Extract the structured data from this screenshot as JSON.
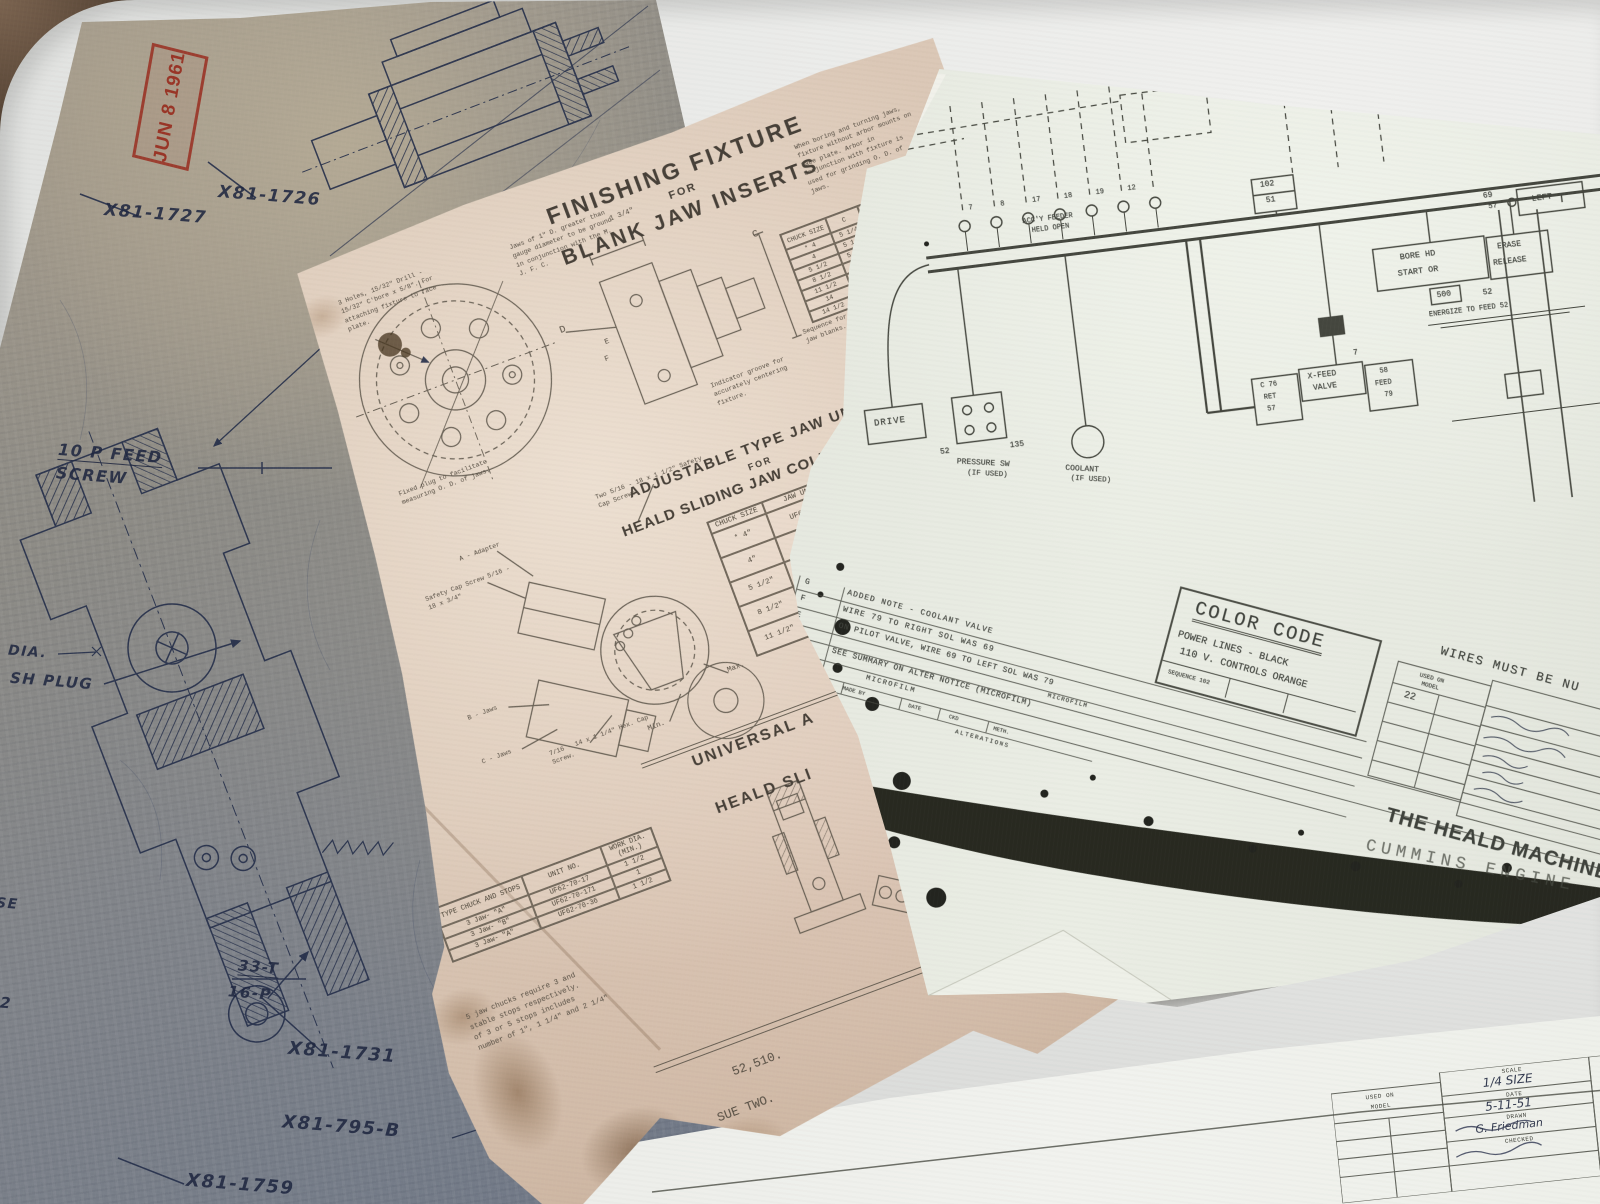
{
  "stamp": {
    "date": "JUN 8 1961"
  },
  "blueprint": {
    "part_1726": "X81-1726",
    "part_1727": "X81-1727",
    "feed_line1": "10 P FEED",
    "feed_line2": "SCREW",
    "dia": "DIA.",
    "sh_plug": "SH PLUG",
    "gear_teeth": "33-T",
    "gear_pitch": "16-P",
    "part_1731": "X81-1731",
    "part_795b": "X81-795-B",
    "part_1759": "X81-1759",
    "edge_se": "SE",
    "edge_2": "2"
  },
  "fixture": {
    "title1": "FINISHING FIXTURE",
    "for1": "FOR",
    "title2": "BLANK JAW INSERTS",
    "note_boring": "When boring and turning jaws, fixture without arbor mounts on face plate. Arbor in conjunction with fixture is used for grinding O. D. of jaws.",
    "note_holes": "3 Holes, 15/32\" Drill - 15/32\" C'bore x 5/8\". For attaching fixture to face plate.",
    "note_jaws": "Jaws of 1\" D. greater than gauge diameter to be ground in conjunction with the M. J. F. C.",
    "note_plug": "Fixed plug to facilitate measuring O. D. of jaws.",
    "note_indicator": "Indicator groove for accurately centering fixture.",
    "note_sequence": "Sequence for grinding jaw blanks.",
    "dim_134": "1 3/4\"",
    "dim_c": "C",
    "dim_d": "D",
    "dim_e": "E",
    "dim_f": "F",
    "dim_table": {
      "h_chuck": "CHUCK SIZE",
      "h_c": "C",
      "h_d": "D",
      "h_d_tol": "+.0005 -.0000",
      "h_e": "E",
      "rows": [
        [
          "* 4",
          "5 1/4",
          "5.3120"
        ],
        [
          "4",
          "5 1/2",
          "5.5620"
        ],
        [
          "5 1/2",
          "5 5/8",
          "5.3745"
        ],
        [
          "8 1/2",
          "9 7/8",
          "9.40"
        ],
        [
          "11 1/2",
          "- - -",
          "- - -"
        ],
        [
          "14",
          "- - -",
          "- - -"
        ],
        [
          "14 1/2",
          "- - -",
          "- - -"
        ]
      ]
    },
    "adj_title1": "ADJUSTABLE TYPE JAW UNITS",
    "for2": "FOR",
    "adj_title2": "HEALD SLIDING JAW COLLET CHUCK",
    "unit_table": {
      "h1a": "CHUCK",
      "h1b": "SIZE",
      "h2a": "JAW UNIT",
      "h2b": "SET",
      "rows": [
        [
          "* 4\"",
          "UF62-70-160A"
        ],
        [
          "4\"",
          "UF62-70-94"
        ],
        [
          "5 1/2\"",
          "UF62-70-"
        ],
        [
          "8 1/2\"",
          "UF62-"
        ],
        [
          "11 1/2\"",
          ""
        ]
      ]
    },
    "lbl_adapter": "A - Adapter",
    "lbl_cap1": "Safety Cap Screw 5/16 - 18 x 3/4\"",
    "lbl_cap2": "Two 5/16 - 18 x 1 1/2\" Safety Cap Screws.",
    "lbl_bjaws": "B - Jaws",
    "lbl_cjaws": "C - Jaws",
    "lbl_hex": "7/16 - 14 x 1 1/4\" Hex. Cap Screw.",
    "lbl_max": "Max.",
    "lbl_min": "Min.",
    "note_each": "Each wher",
    "uni_title1": "UNIVERSAL A",
    "uni_title2": "HEALD SLI",
    "stop_table": {
      "h1": "TYPE CHUCK AND STOPS",
      "h2": "UNIT NO.",
      "h3": "WORK DIA. (MIN.)",
      "rows": [
        [
          "3 Jaw- \"A\"",
          "UF62-70-17",
          "1 1/2"
        ],
        [
          "3 Jaw- \"B\"",
          "UF62-70-171",
          "1"
        ],
        [
          "3 Jaw- \"A\"",
          "UF62-70-36",
          "1 1/2"
        ]
      ]
    },
    "para": [
      "5 jaw chucks require 3 and",
      "stable stops respectively.",
      "of 3 or 5 stops includes",
      "number of 1\", 1 1/4\" and 2 1/4\""
    ],
    "lbl_nut1": "Square nut (hard)",
    "lbl_nut2": "3/8\" - 16 tap x 3/8\".",
    "lbl_forno": "* For No.",
    "doc_number": "52,510.",
    "issue": "SUE TWO."
  },
  "schematic": {
    "contacts": [
      "7",
      "8",
      "17",
      "18",
      "19",
      "12"
    ],
    "accy1": "ACC'Y FEEDER",
    "accy2": "HELD OPEN",
    "box102": "102",
    "box51": "51",
    "num69": "69",
    "num57": "57",
    "lbl_left": "LEFT",
    "borehd1": "BORE HD",
    "borehd2": "START OR",
    "erase": "ERASE",
    "release": "RELEASE",
    "num500": "500",
    "num52r": "52",
    "energize": "ENERGIZE TO FEED 52",
    "xfeed_l1": "C 76",
    "xfeed_l2": "RET",
    "xfeed_l3": "57",
    "xfeed_m1": "X-FEED",
    "xfeed_m2": "VALVE",
    "xfeed_r1": "58",
    "xfeed_r2": "FEED",
    "xfeed_r3": "79",
    "num7": "7",
    "drive": "DRIVE",
    "num52": "52",
    "num135": "135",
    "pressure1": "PRESSURE SW",
    "pressure2": "(IF USED)",
    "coolant1": "COOLANT",
    "coolant2": "(IF USED)",
    "color_code": {
      "title": "COLOR CODE",
      "line1": "POWER LINES - BLACK",
      "line2": "110 V. CONTROLS ORANGE",
      "seq": "SEQUENCE 102"
    },
    "alt": {
      "r1l": "G",
      "r1t": "ADDED NOTE - COOLANT VALVE",
      "r2l": "F",
      "r2t": "WIRE 79 TO RIGHT SOL WAS 69",
      "r3l": "E",
      "r3t": "ON PILOT VALVE, WIRE 69 TO LEFT SOL WAS 79",
      "r4t": "MICROFILM",
      "r5l": "LET.",
      "r5t": "SEE SUMMARY ON ALTER NOTICE (MICROFILM)",
      "r6t": "MICROFILM",
      "label": "ALTERATIONS",
      "f1": "MADE BY",
      "f2": "DATE",
      "f3": "CKD",
      "f4": "METH."
    },
    "tb": {
      "wires": "WIRES MUST BE NU",
      "cont": "CONT",
      "used_on": "USED ON",
      "model": "MODEL",
      "model_val": "22",
      "patterns": "PATTERNS",
      "grade": "GRADE",
      "company": "THE HEALD MACHINE C",
      "stamp": "CUMMINS ENGINE"
    }
  },
  "model_sheet": {
    "used_on": "USED ON",
    "model": "MODEL",
    "scale_l": "SCALE",
    "scale_v": "1/4 SIZE",
    "date_l": "DATE",
    "date_v": "5-11-51",
    "drawn_l": "DRAWN",
    "drawn_v": "G. Friedman",
    "checked_l": "CHECKED",
    "material_l": "MATERIAL"
  }
}
